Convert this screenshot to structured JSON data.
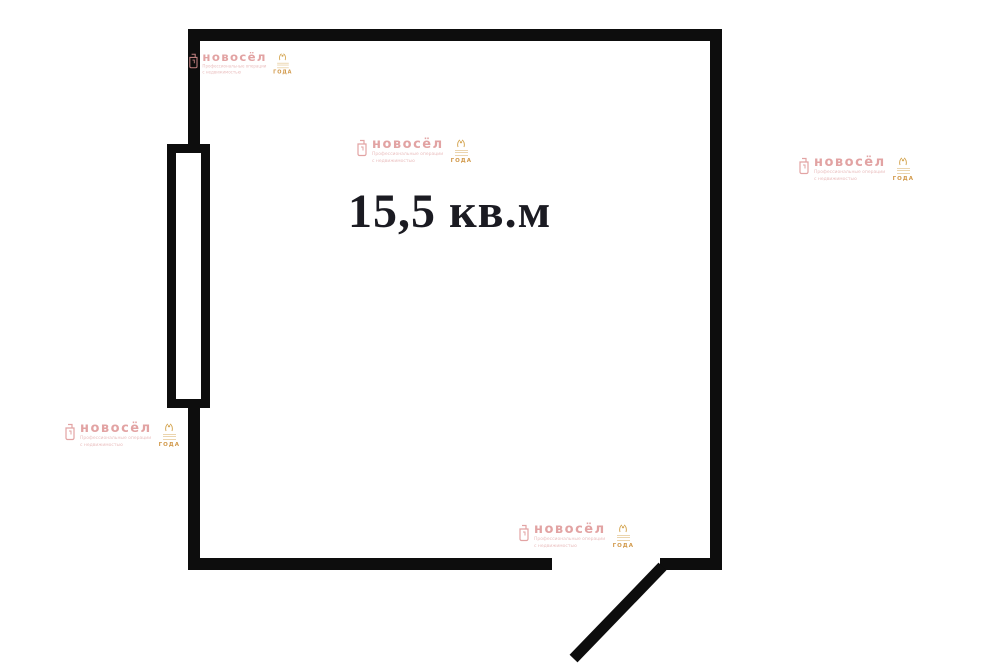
{
  "floor_plan": {
    "area_label": "15,5 кв.м"
  },
  "watermark": {
    "brand": "новосёл",
    "subtitle_line1": "Профессиональные операции",
    "subtitle_line2": "с недвижимостью",
    "badge_year": "ГОДА"
  },
  "colors": {
    "background": "#ffffff",
    "wall": "#0d0d0d",
    "area_label_text": "#1b1b22",
    "watermark_pink": "#dd9494",
    "watermark_badge_orange": "#c9872a"
  }
}
